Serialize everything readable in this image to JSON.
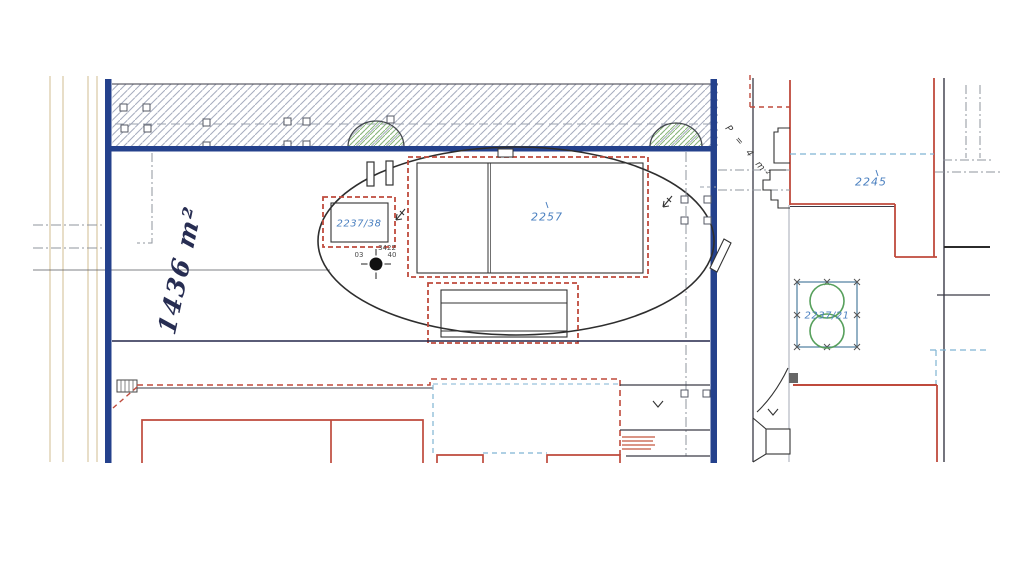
{
  "plan": {
    "parcels": {
      "small_building": "2237/38",
      "main_building": "2257",
      "right_parcel": "2245",
      "square_parcel": "2237/21"
    },
    "annotations": {
      "handwritten_area": "1436 m²",
      "area_note": "P = 4 m²"
    },
    "survey_point": {
      "id": "3422",
      "value_left": "03",
      "value_right": "40"
    },
    "colors": {
      "boundary_blue": "#24418c",
      "building_red": "#bf4a3c",
      "parcel_label_blue": "#4b80c0",
      "vegetation_green": "#57a05c",
      "utility_blue_dashed": "#7fb3d3",
      "hatch_gray": "#a6acbe",
      "margin_tan": "#d9c9a4"
    }
  }
}
